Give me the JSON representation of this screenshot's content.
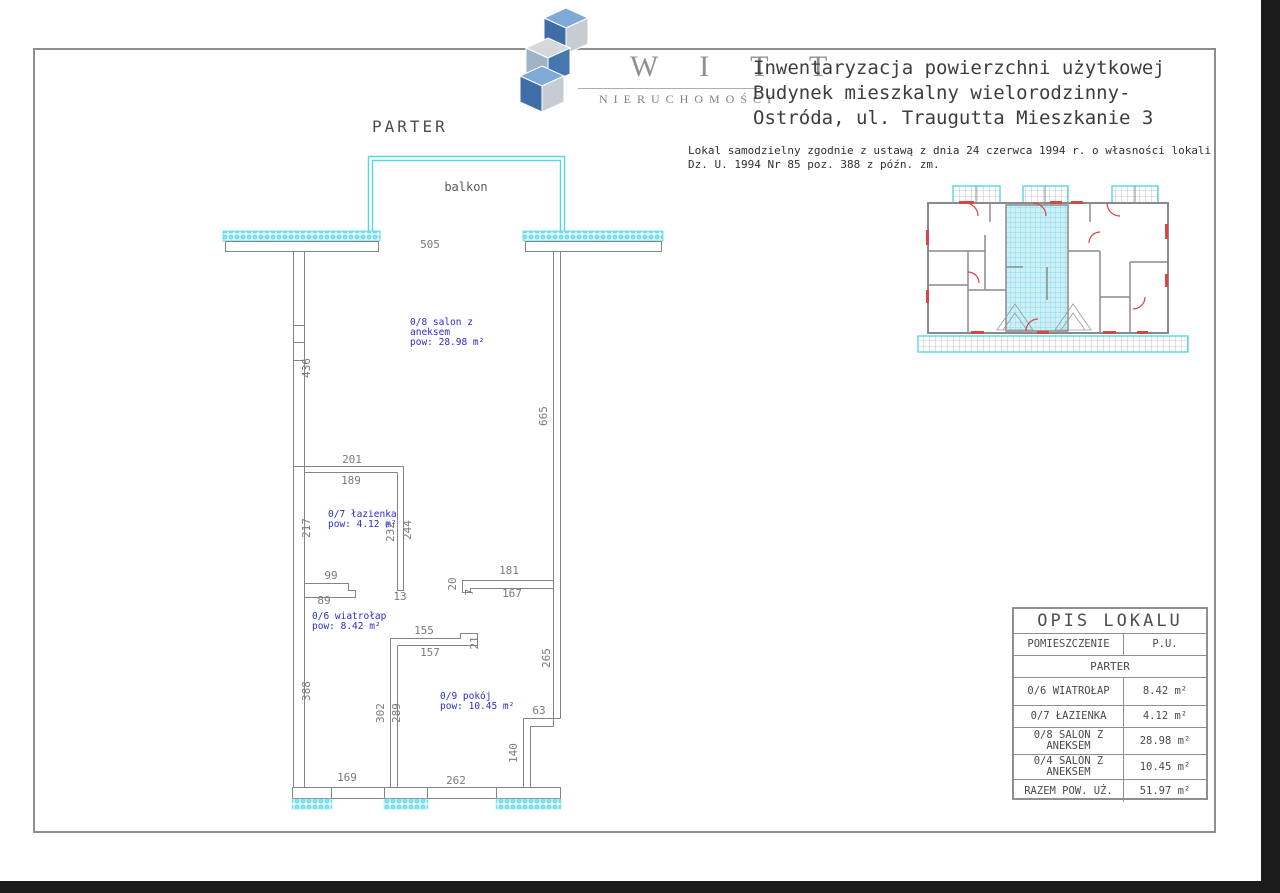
{
  "colors": {
    "accent_cyan": "#55d7e8",
    "wall_gray": "#848484",
    "label_blue": "#2b2bcf",
    "door_red": "#d84545"
  },
  "header": {
    "logo": {
      "brand": "W I T T",
      "subbrand": "NIERUCHOMOŚCI"
    },
    "title_lines": [
      "Inwentaryzacja powierzchni użytkowej",
      "Budynek mieszkalny wielorodzinny-",
      "Ostróda, ul. Traugutta Mieszkanie 3"
    ],
    "legal_lines": [
      "Lokal samodzielny zgodnie z ustawą z dnia 24 czerwca 1994 r. o własności lokali",
      "Dz. U. 1994 Nr 85 poz. 388 z późn. zm."
    ]
  },
  "plan": {
    "floor_label": "PARTER",
    "balcony_label": "balkon",
    "rooms": [
      {
        "lines": [
          "0/8 salon z",
          "aneksem",
          "pow: 28.98 m²"
        ],
        "x": 410,
        "y": 325
      },
      {
        "lines": [
          "0/7 łazienka",
          "pow: 4.12 m²"
        ],
        "x": 328,
        "y": 517
      },
      {
        "lines": [
          "0/6 wiatrołap",
          "pow: 8.42 m²"
        ],
        "x": 312,
        "y": 619
      },
      {
        "lines": [
          "0/9 pokój",
          "pow: 10.45 m²"
        ],
        "x": 440,
        "y": 699
      }
    ],
    "dimensions": [
      {
        "v": "505",
        "x": 430,
        "y": 248,
        "rot": 0
      },
      {
        "v": "436",
        "x": 310,
        "y": 368,
        "rot": -90
      },
      {
        "v": "665",
        "x": 547,
        "y": 416,
        "rot": -90
      },
      {
        "v": "201",
        "x": 352,
        "y": 463,
        "rot": 0
      },
      {
        "v": "189",
        "x": 351,
        "y": 484,
        "rot": 0
      },
      {
        "v": "217",
        "x": 310,
        "y": 528,
        "rot": -90
      },
      {
        "v": "232",
        "x": 394,
        "y": 532,
        "rot": -90
      },
      {
        "v": "244",
        "x": 411,
        "y": 530,
        "rot": -90
      },
      {
        "v": "99",
        "x": 331,
        "y": 579,
        "rot": 0
      },
      {
        "v": "89",
        "x": 324,
        "y": 604,
        "rot": 0
      },
      {
        "v": "13",
        "x": 400,
        "y": 600,
        "rot": 0
      },
      {
        "v": "20",
        "x": 456,
        "y": 584,
        "rot": -90
      },
      {
        "v": "7",
        "x": 473,
        "y": 592,
        "rot": -90
      },
      {
        "v": "181",
        "x": 509,
        "y": 574,
        "rot": 0
      },
      {
        "v": "167",
        "x": 512,
        "y": 597,
        "rot": 0
      },
      {
        "v": "155",
        "x": 424,
        "y": 634,
        "rot": 0
      },
      {
        "v": "157",
        "x": 430,
        "y": 656,
        "rot": 0
      },
      {
        "v": "21",
        "x": 478,
        "y": 643,
        "rot": -90
      },
      {
        "v": "265",
        "x": 550,
        "y": 658,
        "rot": -90
      },
      {
        "v": "302",
        "x": 384,
        "y": 713,
        "rot": -90
      },
      {
        "v": "289",
        "x": 400,
        "y": 713,
        "rot": -90
      },
      {
        "v": "388",
        "x": 310,
        "y": 691,
        "rot": -90
      },
      {
        "v": "63",
        "x": 539,
        "y": 714,
        "rot": 0
      },
      {
        "v": "140",
        "x": 517,
        "y": 753,
        "rot": -90
      },
      {
        "v": "169",
        "x": 347,
        "y": 781,
        "rot": 0
      },
      {
        "v": "262",
        "x": 456,
        "y": 784,
        "rot": 0
      }
    ]
  },
  "table": {
    "title": "OPIS LOKALU",
    "col_room": "POMIESZCZENIE",
    "col_area": "P.U.",
    "section": "PARTER",
    "rows": [
      {
        "name": "0/6 WIATROŁAP",
        "area": "8.42 m²"
      },
      {
        "name": "0/7 ŁAZIENKA",
        "area": "4.12 m²"
      },
      {
        "name": "0/8 SALON Z ANEKSEM",
        "area": "28.98 m²"
      },
      {
        "name": "0/4 SALON Z ANEKSEM",
        "area": "10.45 m²"
      },
      {
        "name": "RAZEM POW. UŻ.",
        "area": "51.97 m²"
      }
    ]
  }
}
